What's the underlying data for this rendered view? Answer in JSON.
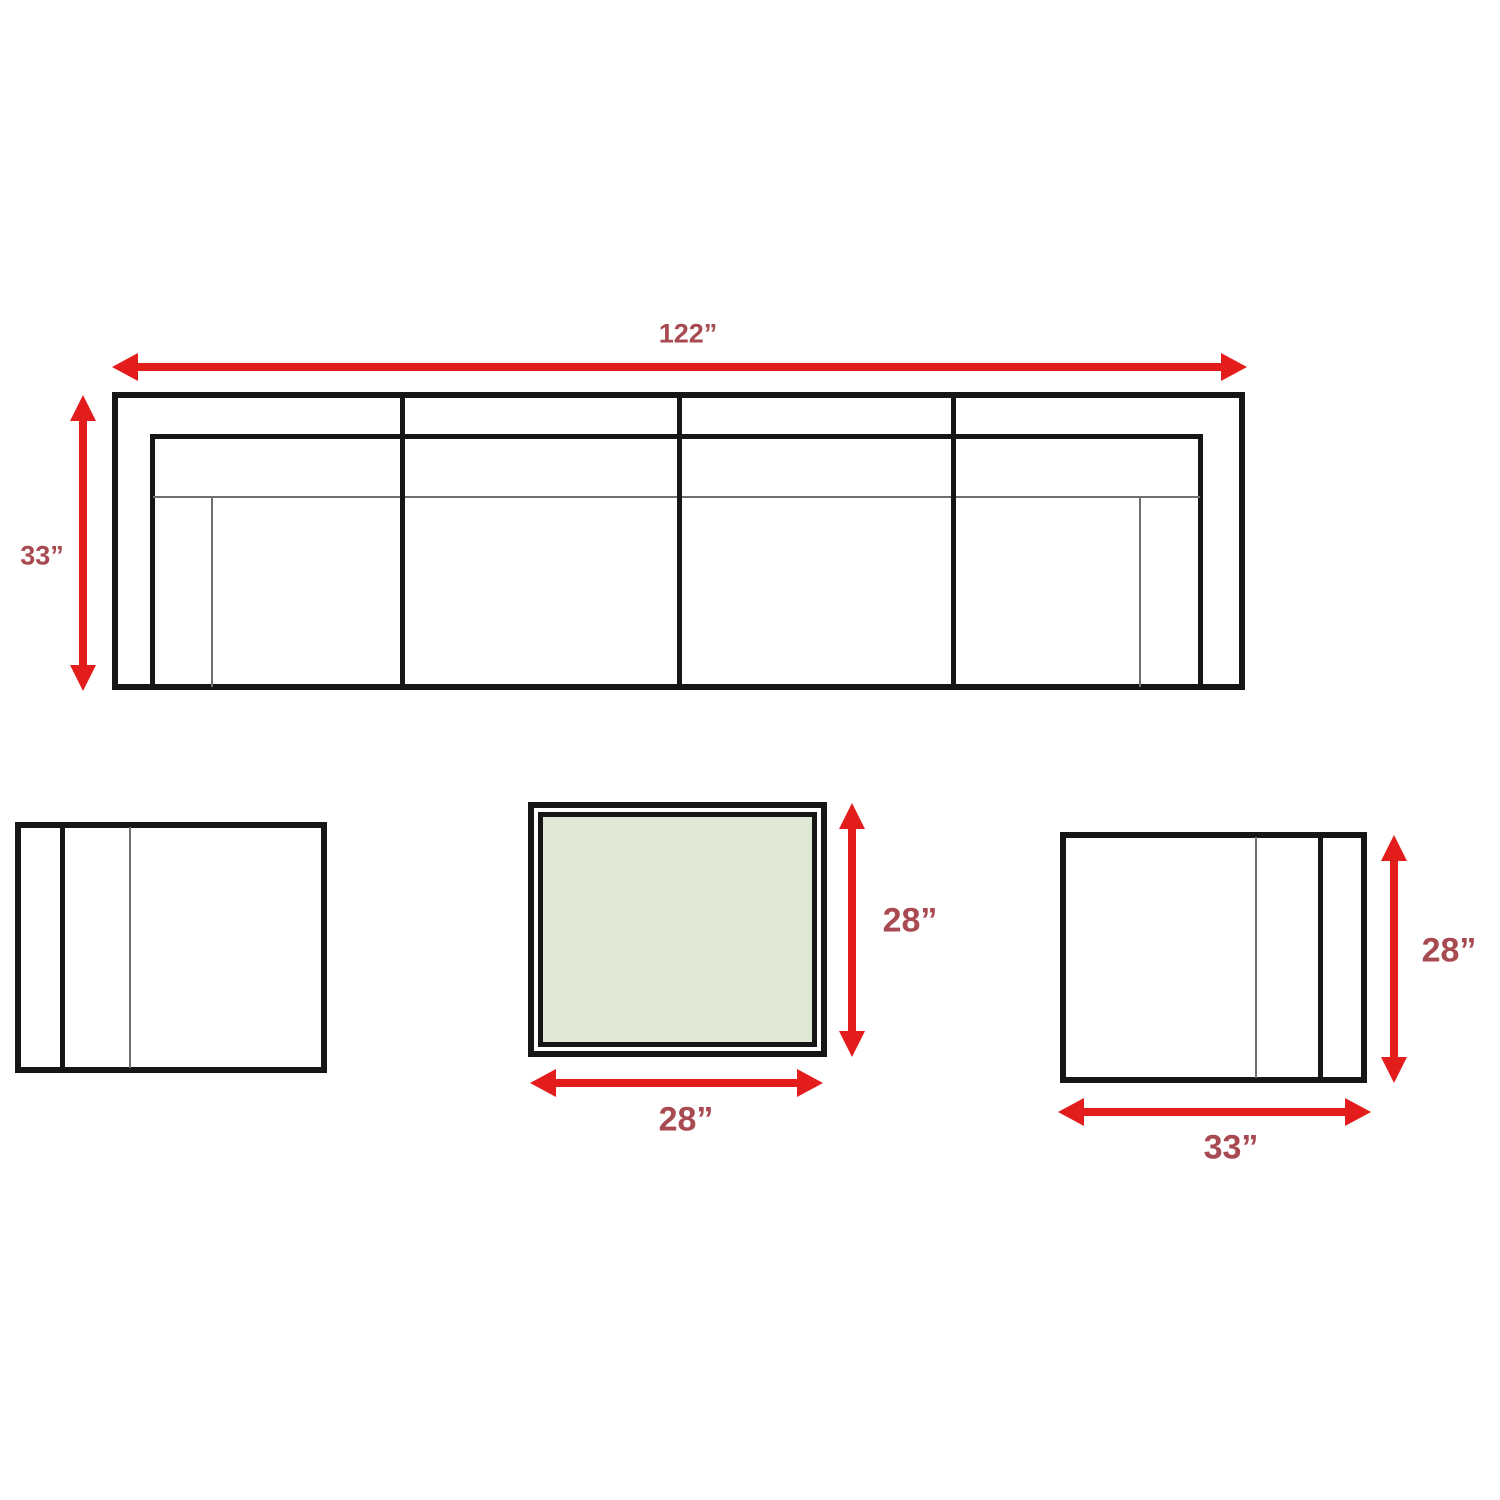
{
  "diagram": {
    "sofa": {
      "width_label": "122”",
      "depth_label": "33”"
    },
    "coffee_table": {
      "height_label": "28”",
      "width_label": "28”"
    },
    "club_chair": {
      "height_label": "28”",
      "width_label": "33”"
    },
    "colors": {
      "dimension_arrow": "#e31c1c",
      "dimension_label": "#a84a51",
      "outline": "#161616",
      "thin_line": "#6f6f6f",
      "table_top_fill": "#dfe8d4",
      "background": "#ffffff"
    },
    "icons": {
      "dimension_arrow": "double-headed-arrow-icon"
    }
  }
}
